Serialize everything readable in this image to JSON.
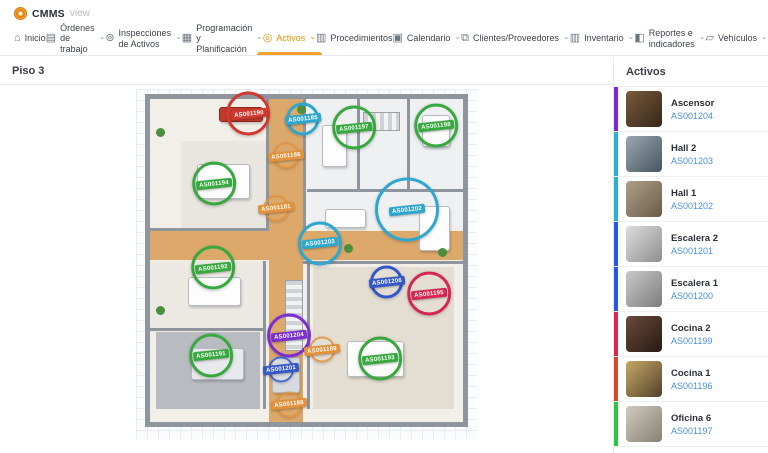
{
  "brand": {
    "name": "CMMS",
    "suffix": "view"
  },
  "accent_color": "#e8930c",
  "nav": {
    "items": [
      {
        "label": "Inicio",
        "icon": "home-icon",
        "caret": false,
        "active": false,
        "wrap": false
      },
      {
        "label": "Órdenes de trabajo",
        "icon": "work-orders-icon",
        "caret": true,
        "active": false,
        "wrap": true
      },
      {
        "label": "Inspecciones de Activos",
        "icon": "inspections-icon",
        "caret": true,
        "active": false,
        "wrap": true
      },
      {
        "label": "Programación y Planificación",
        "icon": "planning-icon",
        "caret": true,
        "active": false,
        "wrap": true
      },
      {
        "label": "Activos",
        "icon": "assets-icon",
        "caret": true,
        "active": true,
        "wrap": false
      },
      {
        "label": "Procedimientos",
        "icon": "procedures-icon",
        "caret": false,
        "active": false,
        "wrap": false
      },
      {
        "label": "Calendario",
        "icon": "calendar-icon",
        "caret": true,
        "active": false,
        "wrap": false
      },
      {
        "label": "Clientes/Proveedores",
        "icon": "clients-icon",
        "caret": true,
        "active": false,
        "wrap": false
      },
      {
        "label": "Inventario",
        "icon": "inventory-icon",
        "caret": true,
        "active": false,
        "wrap": false
      },
      {
        "label": "Reportes e indicadores",
        "icon": "reports-icon",
        "caret": true,
        "active": false,
        "wrap": true
      },
      {
        "label": "Vehículos",
        "icon": "vehicles-icon",
        "caret": true,
        "active": false,
        "wrap": false
      },
      {
        "label": "Portal de solicitudes",
        "icon": "portal-icon",
        "caret": false,
        "active": false,
        "wrap": false
      }
    ]
  },
  "page": {
    "title": "Piso 3"
  },
  "floorplan": {
    "badges": [
      {
        "id": "AS001190",
        "x": 33,
        "y": 7,
        "color": "#d03a2e",
        "size": "n"
      },
      {
        "id": "AS001185",
        "x": 49,
        "y": 8.5,
        "color": "#2ea7cf",
        "size": "s"
      },
      {
        "id": "AS001197",
        "x": 64,
        "y": 11,
        "color": "#38a93f",
        "size": "n"
      },
      {
        "id": "AS001198",
        "x": 88,
        "y": 10.5,
        "color": "#38a93f",
        "size": "n"
      },
      {
        "id": "AS001186",
        "x": 44,
        "y": 19,
        "color": "#e2913c",
        "size": "p"
      },
      {
        "id": "AS001194",
        "x": 23,
        "y": 27,
        "color": "#38a93f",
        "size": "n"
      },
      {
        "id": "AS001181",
        "x": 41,
        "y": 34,
        "color": "#e2913c",
        "size": "p"
      },
      {
        "id": "AS001202",
        "x": 79.5,
        "y": 34.5,
        "color": "#2ea7cf",
        "size": "b"
      },
      {
        "id": "AS001203",
        "x": 54,
        "y": 44,
        "color": "#2ea7cf",
        "size": "n"
      },
      {
        "id": "AS001192",
        "x": 22.5,
        "y": 51,
        "color": "#38a93f",
        "size": "n"
      },
      {
        "id": "AS001206",
        "x": 73.5,
        "y": 55,
        "color": "#3558c9",
        "size": "s"
      },
      {
        "id": "AS001195",
        "x": 86,
        "y": 58.5,
        "color": "#d62754",
        "size": "n"
      },
      {
        "id": "AS001204",
        "x": 45,
        "y": 70.5,
        "color": "#7b2fd0",
        "size": "n"
      },
      {
        "id": "AS001189",
        "x": 54.5,
        "y": 74.5,
        "color": "#e2913c",
        "size": "p"
      },
      {
        "id": "AS001191",
        "x": 22,
        "y": 76,
        "color": "#38a93f",
        "size": "n"
      },
      {
        "id": "AS001193",
        "x": 71.5,
        "y": 77,
        "color": "#38a93f",
        "size": "n"
      },
      {
        "id": "AS001201",
        "x": 42.5,
        "y": 80,
        "color": "#3558c9",
        "size": "p"
      },
      {
        "id": "AS001188",
        "x": 45,
        "y": 90,
        "color": "#e2913c",
        "size": "p"
      }
    ]
  },
  "sidebar": {
    "title": "Activos",
    "items": [
      {
        "name": "Ascensor",
        "id": "AS001204",
        "accent": "#8026e0",
        "thumb1": "#7a5a3a",
        "thumb2": "#35261a"
      },
      {
        "name": "Hall 2",
        "id": "AS001203",
        "accent": "#24b3d4",
        "thumb1": "#9aa7b0",
        "thumb2": "#46565f"
      },
      {
        "name": "Hall 1",
        "id": "AS001202",
        "accent": "#24b3d4",
        "thumb1": "#b0a089",
        "thumb2": "#695a47"
      },
      {
        "name": "Escalera 2",
        "id": "AS001201",
        "accent": "#2458e8",
        "thumb1": "#dedede",
        "thumb2": "#8e8e8e"
      },
      {
        "name": "Escalera 1",
        "id": "AS001200",
        "accent": "#2458e8",
        "thumb1": "#c9c9c9",
        "thumb2": "#7d7d7d"
      },
      {
        "name": "Cocina 2",
        "id": "AS001199",
        "accent": "#e02454",
        "thumb1": "#6a4a3a",
        "thumb2": "#281a12"
      },
      {
        "name": "Cocina 1",
        "id": "AS001196",
        "accent": "#e04424",
        "thumb1": "#c8a868",
        "thumb2": "#53422b"
      },
      {
        "name": "Oficina 6",
        "id": "AS001197",
        "accent": "#28c840",
        "thumb1": "#d0cac0",
        "thumb2": "#878072"
      }
    ]
  }
}
